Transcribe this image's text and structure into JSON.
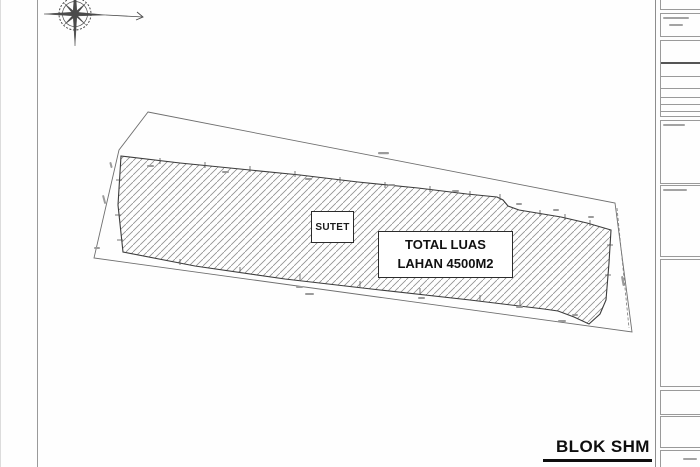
{
  "plan": {
    "sutet_label": "SUTET",
    "area_label_line1": "TOTAL LUAS",
    "area_label_line2": "LAHAN 4500M2"
  },
  "footer": {
    "block_label": "BLOK SHM"
  },
  "icons": {
    "compass": "compass-rose-icon"
  },
  "colors": {
    "line_gray": "#8d8d8d",
    "hatch_gray": "#8f8f8f",
    "ink_black": "#1c1c1c"
  }
}
